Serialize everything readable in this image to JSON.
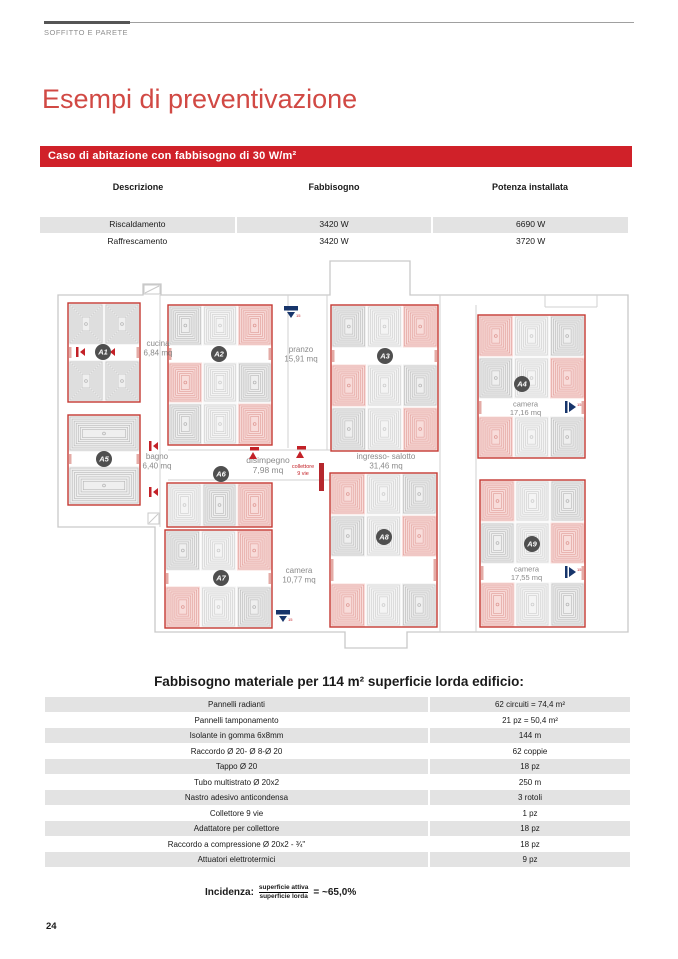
{
  "page": {
    "number": "24"
  },
  "header": {
    "eyebrow": "SOFFITTO E PARETE",
    "title": "Esempi di preventivazione",
    "banner": "Caso di abitazione con fabbisogno di 30 W/m²"
  },
  "colors": {
    "accent_red": "#d02129",
    "title_red": "#d14944",
    "stripe_gray": "#e3e3e3",
    "plan_outline": "#c9c9c9",
    "zone_border": "#c53a33",
    "badge_gray": "#4f4f4f",
    "flag_blue": "#17356b"
  },
  "summary_table": {
    "headers": [
      "Descrizione",
      "Fabbisogno",
      "Potenza installata"
    ],
    "rows": [
      [
        "Riscaldamento",
        "3420 W",
        "6690 W"
      ],
      [
        "Raffrescamento",
        "3420 W",
        "3720 W"
      ]
    ]
  },
  "plan": {
    "outline": "M58,295 H143 V284 H161 V295 H330 V261 H410 V295 H628 V632 H407 V648 H345 V632 H155 V527 H58 Z",
    "inner_lines": [
      [
        160,
        295,
        160,
        527
      ],
      [
        288,
        295,
        288,
        448
      ],
      [
        327,
        295,
        327,
        450
      ],
      [
        440,
        295,
        440,
        632
      ],
      [
        476,
        305,
        476,
        632
      ],
      [
        168,
        450,
        330,
        450
      ],
      [
        168,
        480,
        330,
        480
      ],
      [
        545,
        295,
        545,
        307
      ],
      [
        545,
        307,
        597,
        307
      ],
      [
        597,
        295,
        597,
        307
      ]
    ],
    "hatch_boxes": [
      [
        144,
        285,
        16,
        9
      ],
      [
        148,
        513,
        11,
        11
      ]
    ],
    "cell_colors": {
      "g": {
        "bg": "#efefef",
        "st": "#b7b7b7"
      },
      "l": {
        "bg": "#f4f4f4",
        "st": "#cdcdcd"
      },
      "r": {
        "bg": "#f8dcda",
        "st": "#df9a95"
      }
    },
    "zones": [
      {
        "id": "A1",
        "x": 68,
        "y": 303,
        "w": 72,
        "h": 99,
        "badge": [
          103,
          352
        ],
        "rows": [
          {
            "h": 42,
            "cells": [
              "g",
              "g"
            ]
          },
          {
            "h": 15,
            "band": true,
            "valves": true
          },
          {
            "h": 42,
            "cells": [
              "g",
              "g"
            ]
          }
        ]
      },
      {
        "id": "A2",
        "x": 168,
        "y": 305,
        "w": 104,
        "h": 140,
        "badge": [
          219,
          354
        ],
        "rows": [
          {
            "h": 41,
            "cells": [
              "g",
              "l",
              "r"
            ]
          },
          {
            "h": 16,
            "band": true
          },
          {
            "h": 41,
            "cells": [
              "r",
              "l",
              "g"
            ]
          },
          {
            "h": 42,
            "cells": [
              "g",
              "l",
              "r"
            ]
          }
        ]
      },
      {
        "id": "A3",
        "x": 331,
        "y": 305,
        "w": 107,
        "h": 146,
        "badge": [
          385,
          356
        ],
        "rows": [
          {
            "h": 43,
            "cells": [
              "g",
              "l",
              "r"
            ]
          },
          {
            "h": 16,
            "band": true
          },
          {
            "h": 43,
            "cells": [
              "r",
              "l",
              "g"
            ]
          },
          {
            "h": 44,
            "cells": [
              "g",
              "l",
              "r"
            ]
          }
        ]
      },
      {
        "id": "A4",
        "x": 478,
        "y": 315,
        "w": 107,
        "h": 143,
        "badge": [
          522,
          384
        ],
        "rows": [
          {
            "h": 42,
            "cells": [
              "r",
              "l",
              "g"
            ]
          },
          {
            "h": 42,
            "cells": [
              "g",
              "l",
              "r"
            ]
          },
          {
            "h": 17,
            "band": true,
            "label": [
              "camera",
              "17,16 mq"
            ],
            "flag": true
          },
          {
            "h": 42,
            "cells": [
              "r",
              "l",
              "g"
            ]
          }
        ]
      },
      {
        "id": "A5",
        "x": 68,
        "y": 415,
        "w": 72,
        "h": 90,
        "badge": [
          104,
          459
        ],
        "rows": [
          {
            "h": 37,
            "cells": [
              "g"
            ]
          },
          {
            "h": 14,
            "band": true
          },
          {
            "h": 39,
            "cells": [
              "g"
            ]
          }
        ]
      },
      {
        "id": "A6",
        "x": 167,
        "y": 483,
        "w": 105,
        "h": 44,
        "badge": [
          221,
          474
        ],
        "rows": [
          {
            "h": 44,
            "cells": [
              "l",
              "g",
              "r"
            ]
          }
        ]
      },
      {
        "id": "A7",
        "x": 165,
        "y": 530,
        "w": 107,
        "h": 98,
        "badge": [
          221,
          578
        ],
        "rows": [
          {
            "h": 41,
            "cells": [
              "g",
              "l",
              "r"
            ]
          },
          {
            "h": 15,
            "band": true
          },
          {
            "h": 42,
            "cells": [
              "r",
              "l",
              "g"
            ]
          }
        ]
      },
      {
        "id": "A8",
        "x": 330,
        "y": 473,
        "w": 107,
        "h": 154,
        "badge": [
          384,
          537
        ],
        "rows": [
          {
            "h": 42,
            "cells": [
              "r",
              "l",
              "g"
            ]
          },
          {
            "h": 42,
            "cells": [
              "g",
              "l",
              "r"
            ]
          },
          {
            "h": 26,
            "band": true
          },
          {
            "h": 44,
            "cells": [
              "r",
              "l",
              "g"
            ]
          }
        ]
      },
      {
        "id": "A9",
        "x": 480,
        "y": 480,
        "w": 105,
        "h": 147,
        "badge": [
          532,
          544
        ],
        "rows": [
          {
            "h": 42,
            "cells": [
              "r",
              "l",
              "g"
            ]
          },
          {
            "h": 42,
            "cells": [
              "g",
              "l",
              "r"
            ]
          },
          {
            "h": 18,
            "band": true,
            "label": [
              "camera",
              "17,55 mq"
            ],
            "flag": true
          },
          {
            "h": 45,
            "cells": [
              "r",
              "l",
              "g"
            ]
          }
        ]
      }
    ],
    "labels": [
      {
        "lines": [
          "cucina",
          "6,84 mq"
        ],
        "x": 158,
        "y": 346
      },
      {
        "lines": [
          "pranzo",
          "15,91 mq"
        ],
        "x": 301,
        "y": 352
      },
      {
        "lines": [
          "bagno",
          "6,40 mq"
        ],
        "x": 157,
        "y": 459
      },
      {
        "lines": [
          "disimpegno",
          "7,98 mq"
        ],
        "x": 268,
        "y": 463,
        "fs": 8.5
      },
      {
        "lines": [
          "ingresso- salotto",
          "31,46 mq"
        ],
        "x": 386,
        "y": 459
      },
      {
        "lines": [
          "camera",
          "10,77 mq"
        ],
        "x": 299,
        "y": 573
      },
      {
        "lines": [
          "collettore",
          "9 vie"
        ],
        "x": 303,
        "y": 468,
        "fs": 5.5,
        "red": true
      }
    ],
    "icons": [
      {
        "t": "flagdown",
        "x": 291,
        "y": 306
      },
      {
        "t": "flagdown",
        "x": 283,
        "y": 610
      },
      {
        "t": "tri",
        "x": 249,
        "y": 452
      },
      {
        "t": "tri",
        "x": 296,
        "y": 451
      },
      {
        "t": "coll",
        "x": 319,
        "y": 463
      },
      {
        "t": "valve",
        "x": 149,
        "y": 441
      },
      {
        "t": "valve",
        "x": 149,
        "y": 487
      }
    ]
  },
  "materials_table": {
    "title": "Fabbisogno materiale per 114 m² superficie lorda edificio:",
    "rows": [
      [
        "Pannelli radianti",
        "62 circuiti = 74,4 m²"
      ],
      [
        "Pannelli tamponamento",
        "21 pz = 50,4 m²"
      ],
      [
        "Isolante in gomma 6x8mm",
        "144 m"
      ],
      [
        "Raccordo Ø 20- Ø 8-Ø 20",
        "62 coppie"
      ],
      [
        "Tappo Ø 20",
        "18 pz"
      ],
      [
        "Tubo multistrato Ø 20x2",
        "250 m"
      ],
      [
        "Nastro adesivo anticondensa",
        "3 rotoli"
      ],
      [
        "Collettore 9 vie",
        "1 pz"
      ],
      [
        "Adattatore per collettore",
        "18 pz"
      ],
      [
        "Raccordo a compressione Ø 20x2 - ¾\"",
        "18 pz"
      ],
      [
        "Attuatori elettrotermici",
        "9 pz"
      ]
    ]
  },
  "incidenza": {
    "label": "Incidenza:",
    "numerator": "superficie attiva",
    "denominator": "superficie lorda",
    "result": "= ~65,0%"
  }
}
